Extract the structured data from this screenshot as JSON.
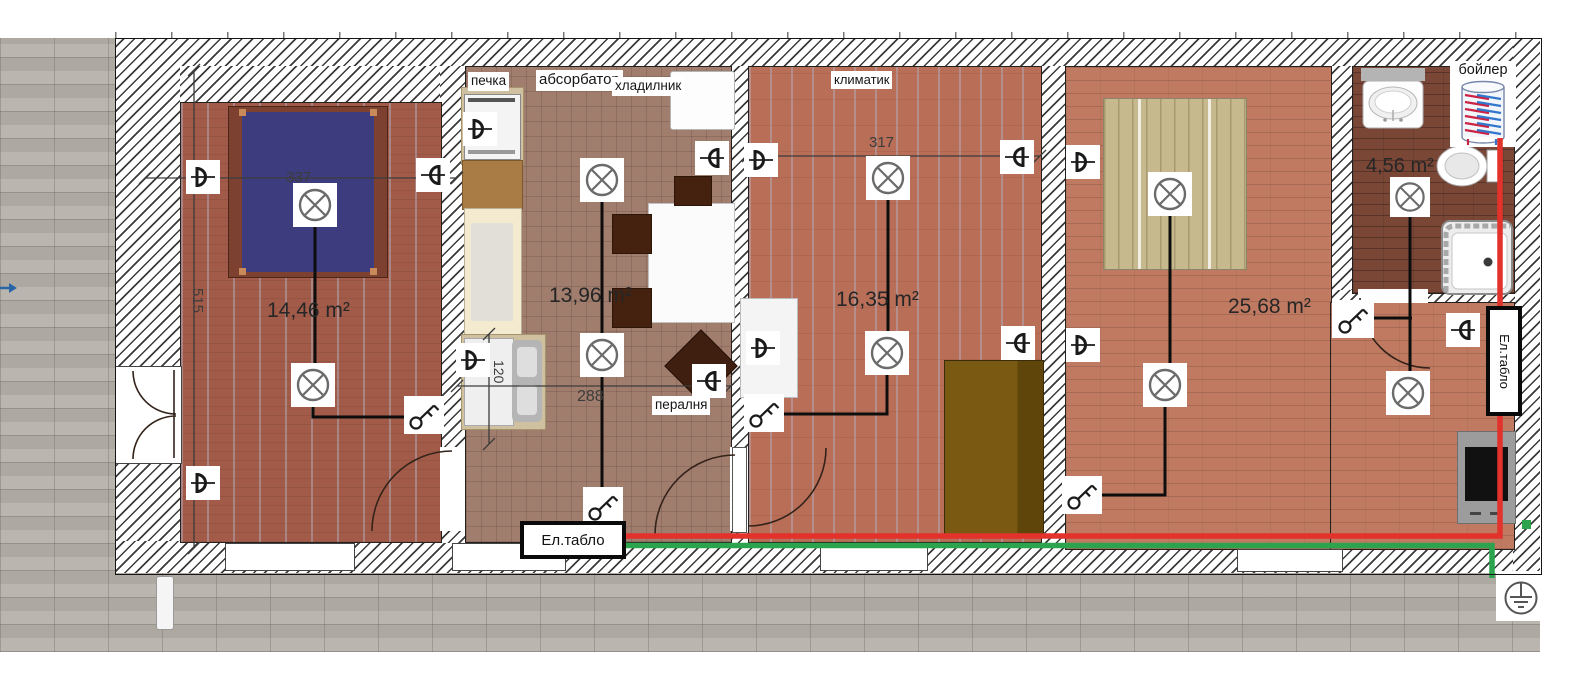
{
  "plan": {
    "labels": {
      "stove": "печка",
      "hood": "абсорбатор",
      "fridge": "хладилник",
      "ac": "климатик",
      "washer": "пералня",
      "boiler": "бойлер",
      "panel": "Ел.табло"
    },
    "areas": {
      "bedroom": "14,46 m²",
      "kitchen": "13,96 m²",
      "living": "16,35 m²",
      "big_room": "25,68 m²",
      "bathroom": "4,56 m²"
    },
    "dimensions": {
      "bedroom_width": "337",
      "house_depth": "515",
      "kitchen_width": "288",
      "counter_depth": "120",
      "living_width": "317"
    },
    "colors": {
      "power_wire": "#e3312b",
      "earth_wire": "#2ca44e",
      "circuit_wire": "#0d0d0d"
    }
  }
}
